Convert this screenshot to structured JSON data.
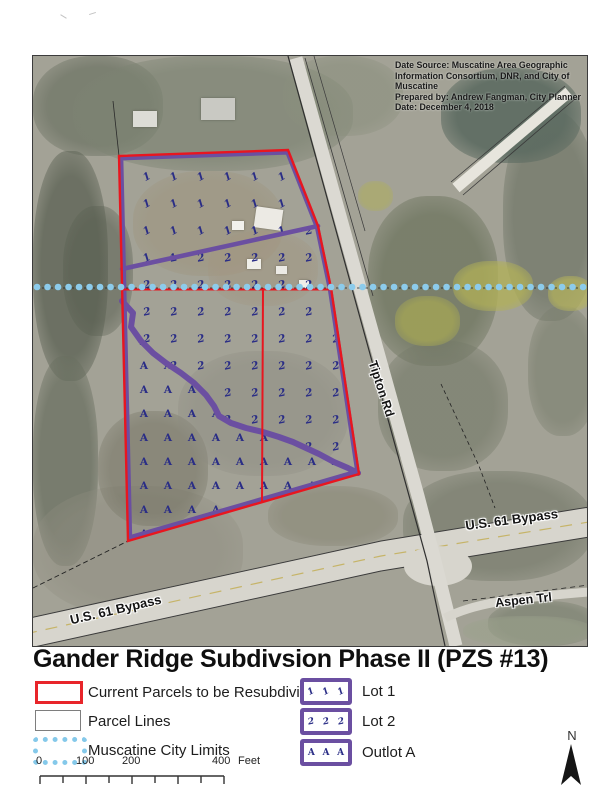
{
  "page": {
    "title": "Gander Ridge Subdivsion Phase II (PZS #13)"
  },
  "map": {
    "credits_lines": [
      "Date Source: Muscatine Area Geographic",
      "Information Consortium, DNR, and City of Muscatine",
      "Prepared by: Andrew Fangman, City Planner",
      "Date: December 4, 2018"
    ],
    "labels": {
      "tipton_rd": "Tipton Rd",
      "us61_bypass_east": "U.S. 61 Bypass",
      "us61_bypass_west": "U.S. 61 Bypass",
      "aspen_trl": "Aspen Trl"
    }
  },
  "legend": {
    "items_left": [
      {
        "label": "Current Parcels to be Resubdivided",
        "swatch": "red-outline"
      },
      {
        "label": "Parcel Lines",
        "swatch": "gray-outline"
      },
      {
        "label": "Muscatine City Limits",
        "swatch": "blue-dotted"
      }
    ],
    "items_right": [
      {
        "label": "Lot 1",
        "symbol": "1"
      },
      {
        "label": "Lot 2",
        "symbol": "2"
      },
      {
        "label": "Outlot A",
        "symbol": "A"
      }
    ]
  },
  "scale_bar": {
    "labels": [
      "0",
      "100",
      "200",
      "400"
    ],
    "unit": "Feet"
  },
  "north_arrow": {
    "label": "N"
  },
  "colors": {
    "parcel_red": "#e8161f",
    "lot_purple": "#6b4fa1",
    "city_limits_blue": "#8ccbeb",
    "marker_navy": "#2a2d86"
  }
}
